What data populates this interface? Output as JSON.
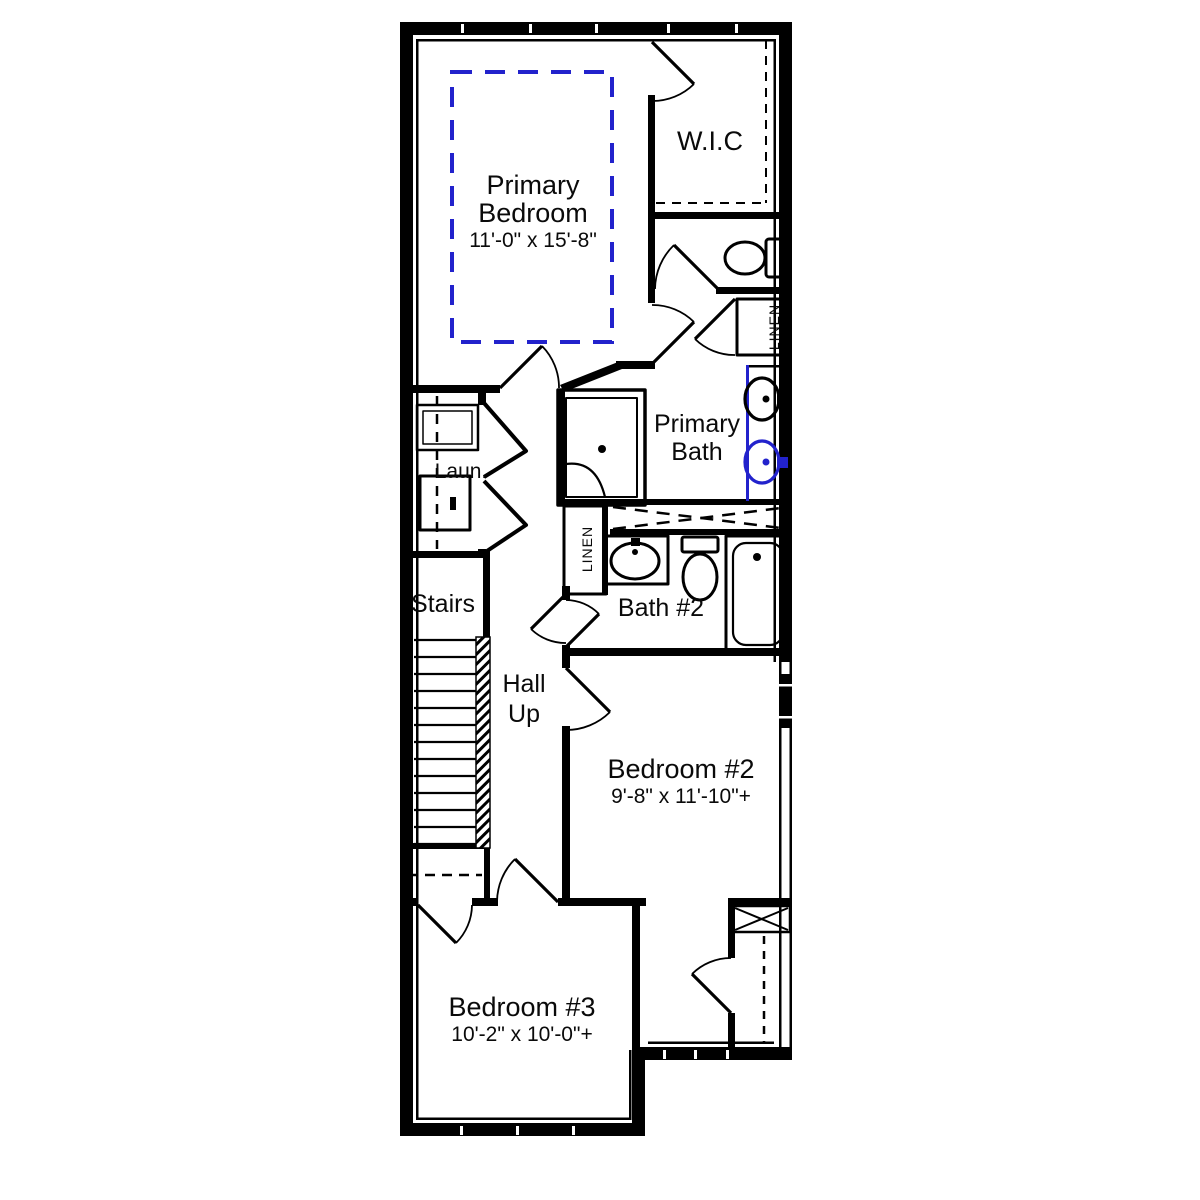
{
  "colors": {
    "wall": "#000000",
    "accent_blue": "#2222cc",
    "background": "#ffffff",
    "text": "#0a0a0a"
  },
  "rooms": {
    "primary_bedroom": {
      "label_line1": "Primary",
      "label_line2": "Bedroom",
      "dimensions": "11'-0\" x 15'-8\""
    },
    "wic": {
      "label": "W.I.C"
    },
    "linen_upper": {
      "label": "LINEN"
    },
    "primary_bath": {
      "label_line1": "Primary",
      "label_line2": "Bath"
    },
    "laundry": {
      "label": "Laun."
    },
    "linen_hall": {
      "label": "LINEN"
    },
    "stairs": {
      "label": "Stairs"
    },
    "hall": {
      "label_line1": "Hall",
      "label_line2": "Up"
    },
    "bath2": {
      "label": "Bath #2"
    },
    "bedroom2": {
      "label": "Bedroom #2",
      "dimensions": "9'-8\" x 11'-10\"+"
    },
    "bedroom3": {
      "label": "Bedroom #3",
      "dimensions": "10'-2\" x 10'-0\"+"
    }
  }
}
